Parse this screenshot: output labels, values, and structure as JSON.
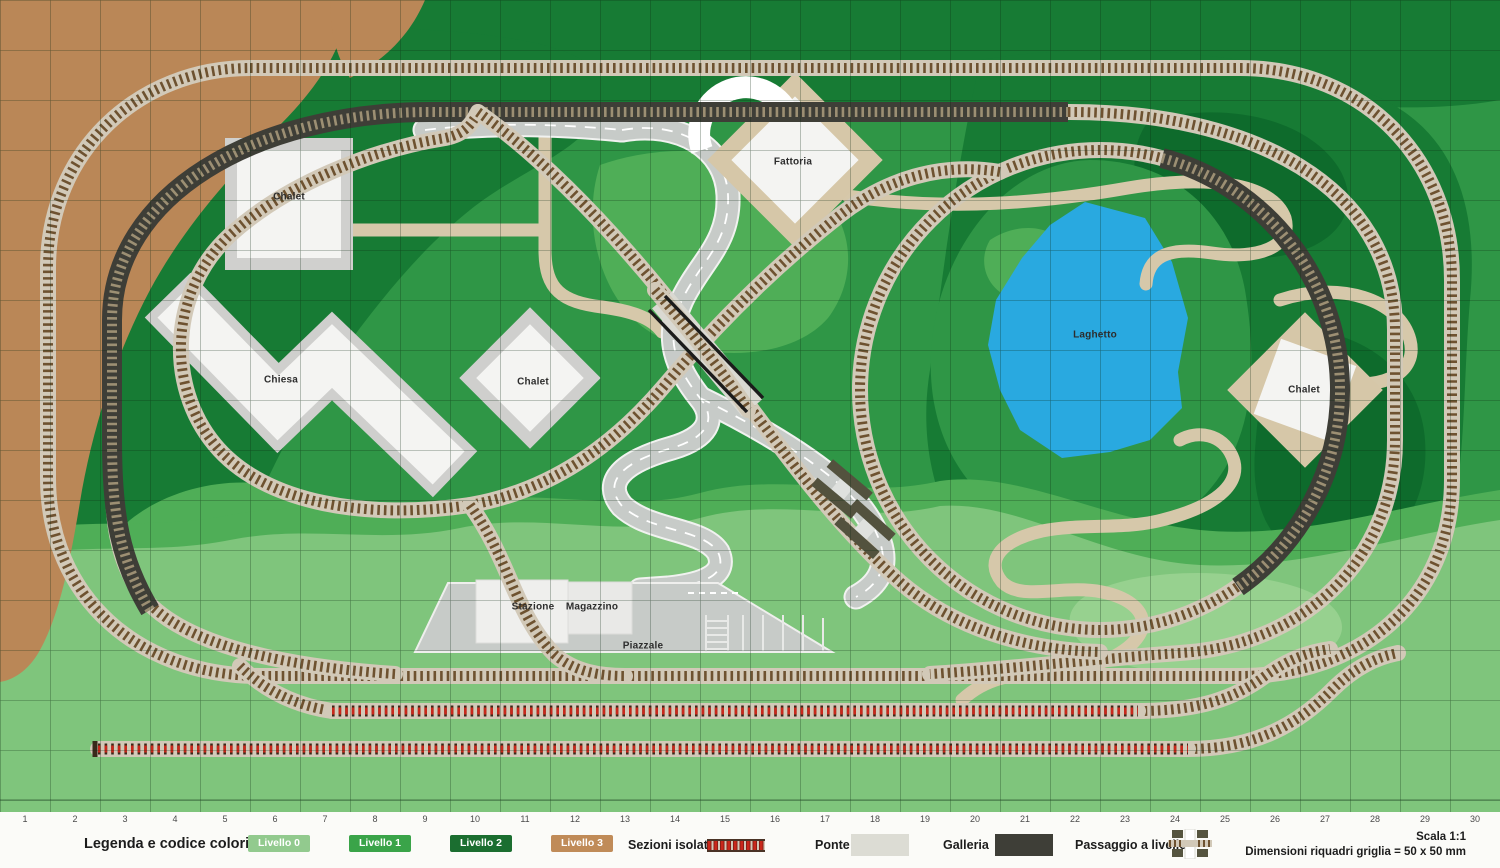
{
  "legend": {
    "title": "Legenda e codice colori:",
    "levels": [
      {
        "label": "Livello 0",
        "color": "#92CA8E"
      },
      {
        "label": "Livello 1",
        "color": "#3AA449"
      },
      {
        "label": "Livello 2",
        "color": "#1B6E30"
      },
      {
        "label": "Livello 3",
        "color": "#C08B58"
      }
    ],
    "items": [
      {
        "label": "Sezioni isolate"
      },
      {
        "label": "Ponte"
      },
      {
        "label": "Galleria"
      },
      {
        "label": "Passaggio a livello"
      }
    ],
    "scale_note": "Scala 1:1",
    "grid_note": "Dimensioni riquadri griglia = 50 x 50 mm"
  },
  "ruler": {
    "numbers": [
      1,
      2,
      3,
      4,
      5,
      6,
      7,
      8,
      9,
      10,
      11,
      12,
      13,
      14,
      15,
      16,
      17,
      18,
      19,
      20,
      21,
      22,
      23,
      24,
      25,
      26,
      27,
      28,
      29,
      30
    ]
  },
  "map": {
    "labels": [
      {
        "text": "Chalet",
        "x": 289,
        "y": 197
      },
      {
        "text": "Chiesa",
        "x": 281,
        "y": 380
      },
      {
        "text": "Chalet",
        "x": 533,
        "y": 382
      },
      {
        "text": "Fattoria",
        "x": 793,
        "y": 162
      },
      {
        "text": "Laghetto",
        "x": 1095,
        "y": 335
      },
      {
        "text": "Chalet",
        "x": 1304,
        "y": 390
      },
      {
        "text": "Stazione",
        "x": 533,
        "y": 607
      },
      {
        "text": "Magazzino",
        "x": 592,
        "y": 607
      },
      {
        "text": "Piazzale",
        "x": 643,
        "y": 646
      }
    ],
    "colors": {
      "livello0": "#7FC57C",
      "livello1": "#2F9646",
      "livello2": "#177B34",
      "livello3": "#BA8757",
      "lake": "#29A9E0",
      "ballast": "#D2C9B8",
      "ties": "#6E5230",
      "tunnel": "#3E3E37",
      "isolated_red": "#C9281B",
      "road": "#C7CBC8",
      "path": "#D6C8AA",
      "building": "#F4F4F2",
      "grid_line": "rgba(10,40,16,0.5)"
    }
  }
}
